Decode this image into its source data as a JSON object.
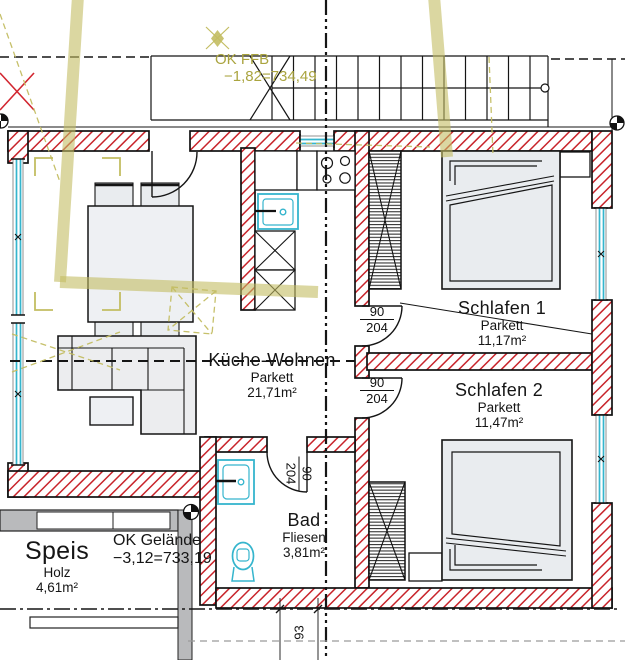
{
  "rooms": {
    "kueche_wohnen": {
      "name": "Küche-Wohnen",
      "floor": "Parkett",
      "area": "21,71m²"
    },
    "schlafen1": {
      "name": "Schlafen 1",
      "floor": "Parkett",
      "area": "11,17m²"
    },
    "schlafen2": {
      "name": "Schlafen 2",
      "floor": "Parkett",
      "area": "11,47m²"
    },
    "bad": {
      "name": "Bad",
      "floor": "Fliesen",
      "area": "3,81m²"
    },
    "speis": {
      "name": "Speis",
      "floor": "Holz",
      "area": "4,61m²"
    }
  },
  "levels": {
    "ffb": {
      "label": "OK FFB",
      "value": "−1,82=734,49"
    },
    "gelaende": {
      "label": "OK Gelände",
      "value": "−3,12=733,19"
    }
  },
  "doors": {
    "schlafen1": {
      "width": "90",
      "height": "204"
    },
    "schlafen2": {
      "width": "90",
      "height": "204"
    },
    "bad": {
      "width": "90",
      "height": "204"
    }
  },
  "dimensions": {
    "bottom_width": "93"
  },
  "colors": {
    "wall_hatch": "#c8242b",
    "window": "#35b5cd",
    "survey_overlay": "#aaa43f",
    "terrain_gray": "#b9babc"
  }
}
